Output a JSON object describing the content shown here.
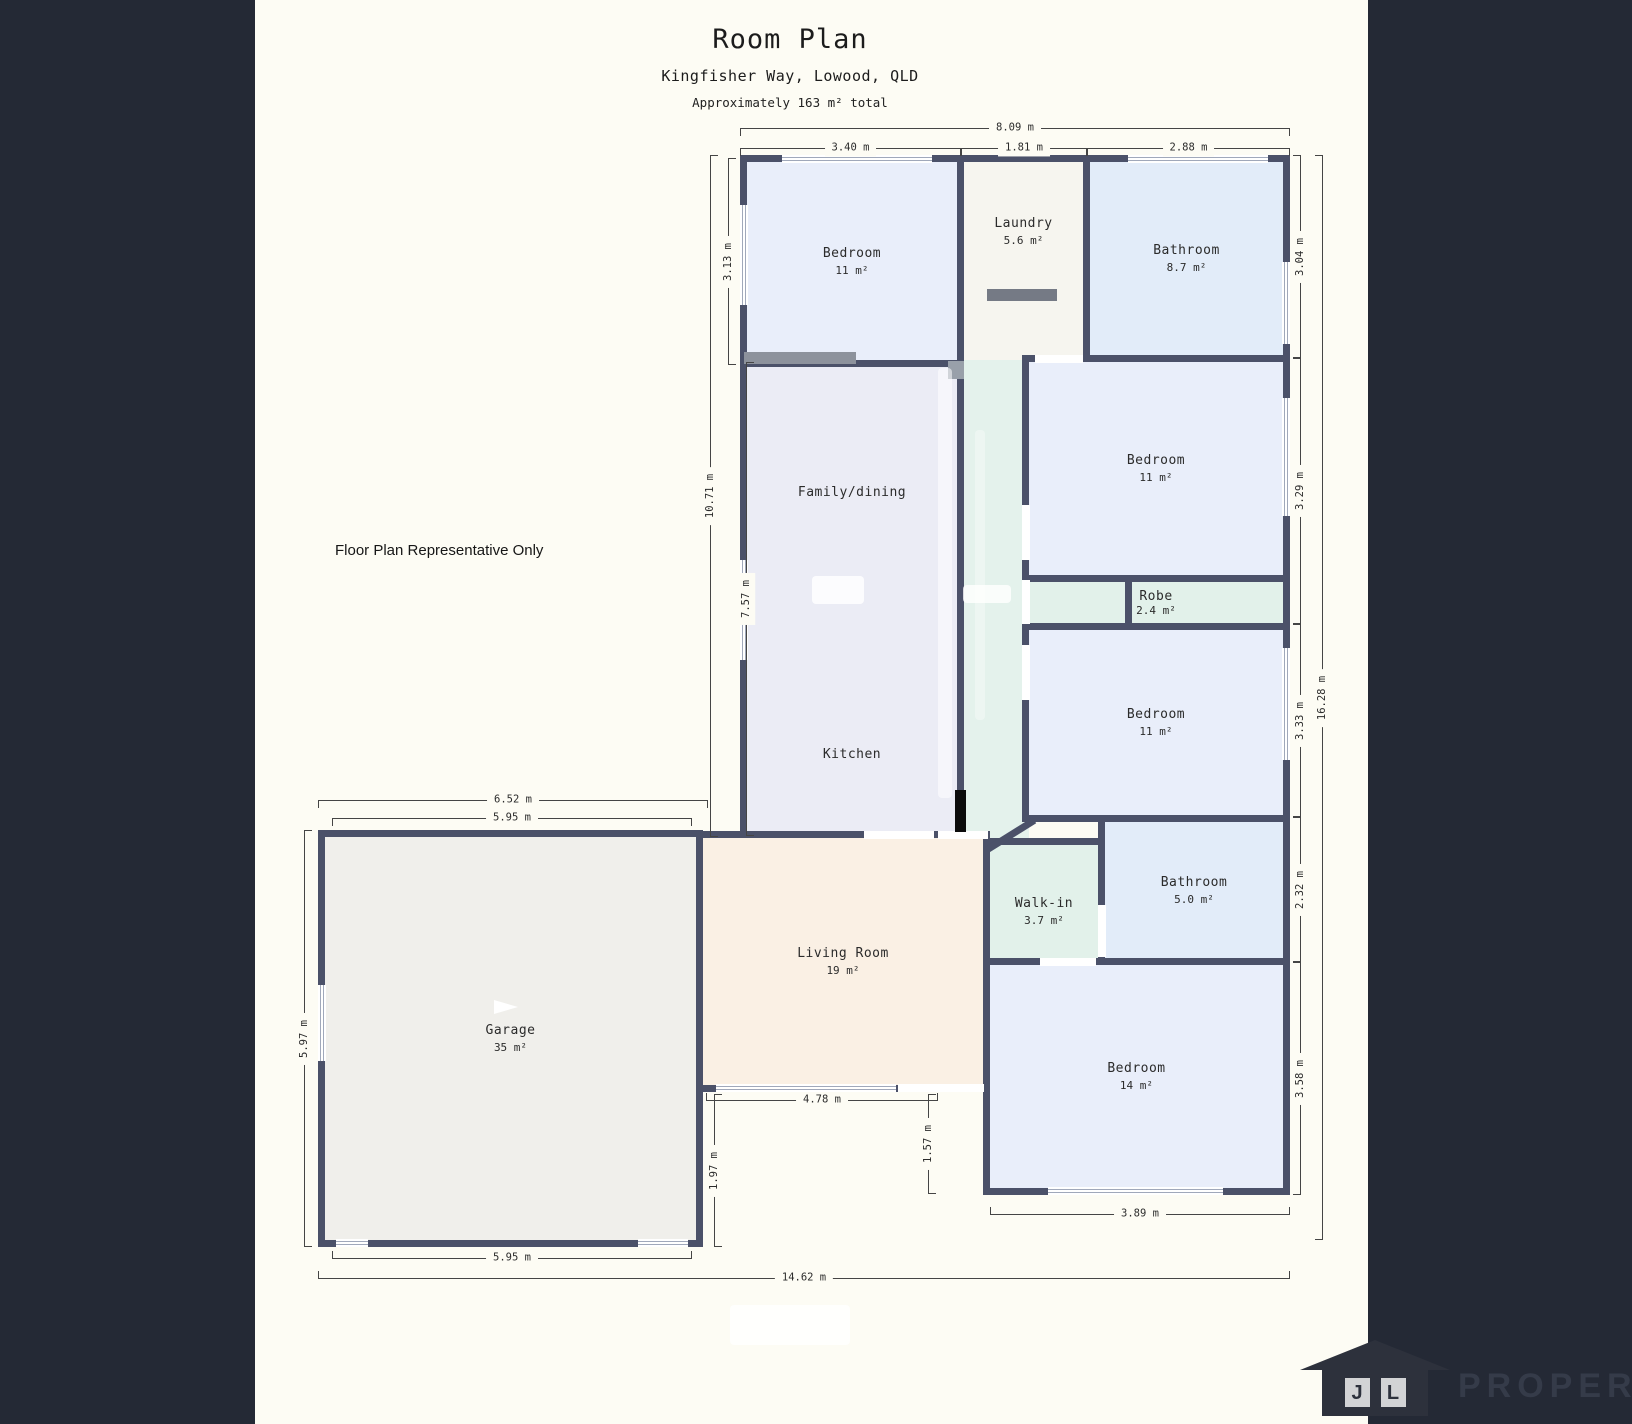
{
  "header": {
    "title": "Room Plan",
    "address": "Kingfisher Way, Lowood, QLD",
    "area_note": "Approximately 163 m² total"
  },
  "disclaimer": "Floor Plan Representative Only",
  "rooms": {
    "bedroom_top": {
      "name": "Bedroom",
      "area": "11 m²"
    },
    "laundry": {
      "name": "Laundry",
      "area": "5.6 m²"
    },
    "bathroom_top": {
      "name": "Bathroom",
      "area": "8.7 m²"
    },
    "bedroom_right_upper": {
      "name": "Bedroom",
      "area": "11 m²"
    },
    "robe": {
      "name": "Robe",
      "area": "2.4 m²"
    },
    "bedroom_right_mid": {
      "name": "Bedroom",
      "area": "11 m²"
    },
    "family": {
      "name": "Family/dining"
    },
    "kitchen": {
      "name": "Kitchen"
    },
    "walk_in": {
      "name": "Walk-in",
      "area": "3.7 m²"
    },
    "bathroom_lower": {
      "name": "Bathroom",
      "area": "5.0 m²"
    },
    "living": {
      "name": "Living Room",
      "area": "19 m²"
    },
    "bedroom_lower": {
      "name": "Bedroom",
      "area": "14 m²"
    },
    "garage": {
      "name": "Garage",
      "area": "35 m²"
    }
  },
  "dims": {
    "top_overall": "8.09 m",
    "top_bedroom": "3.40 m",
    "top_laundry": "1.81 m",
    "top_bathroom": "2.88 m",
    "left_bedroom": "3.13 m",
    "left_overall": "10.71 m",
    "left_family": "7.57 m",
    "right_bathroom": "3.04 m",
    "right_bedroom_upper": "3.29 m",
    "right_bedroom_mid": "3.33 m",
    "right_bathroom_lower": "2.32 m",
    "right_bedroom_lower": "3.58 m",
    "right_overall": "16.28 m",
    "garage_top_outer": "6.52 m",
    "garage_top_inner": "5.95 m",
    "garage_left": "5.97 m",
    "garage_bottom": "5.95 m",
    "bottom_overall": "14.62 m",
    "living_bottom": "4.78 m",
    "living_left": "1.97 m",
    "bedroom_lower_left": "1.57 m",
    "bedroom_lower_bottom": "3.89 m"
  },
  "logo": {
    "initial_j": "J",
    "initial_l": "L",
    "brand": "PROPERTY"
  },
  "colors": {
    "background": "#fdfcf4",
    "panel": "#242935",
    "wall": "#4b5169",
    "floor_bedroom": "#e9eefa",
    "floor_bathroom": "#e2ecf9",
    "floor_hall": "#e4f2ec",
    "floor_family": "#ebecf5",
    "floor_living": "#faf0e4",
    "floor_garage": "#f0efeb",
    "floor_laundry": "#f6f5ef"
  }
}
